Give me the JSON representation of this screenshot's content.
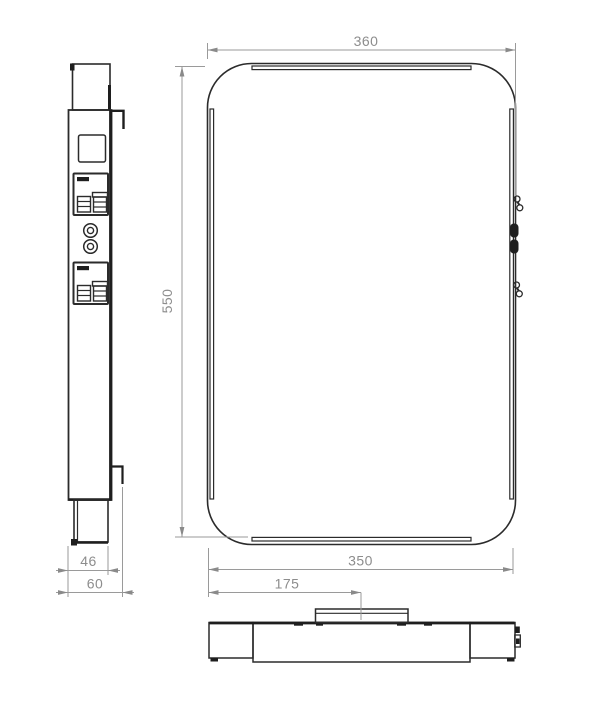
{
  "drawing": {
    "type": "technical-drawing-three-views",
    "colors": {
      "background": "#ffffff",
      "line": "#2b2b2b",
      "dimension": "#8f8f8f"
    },
    "dimensions": {
      "front_width": "360",
      "front_height": "550",
      "bottom_width": "350",
      "tab_offset": "175",
      "side_body_depth": "46",
      "side_total_depth": "60"
    }
  }
}
